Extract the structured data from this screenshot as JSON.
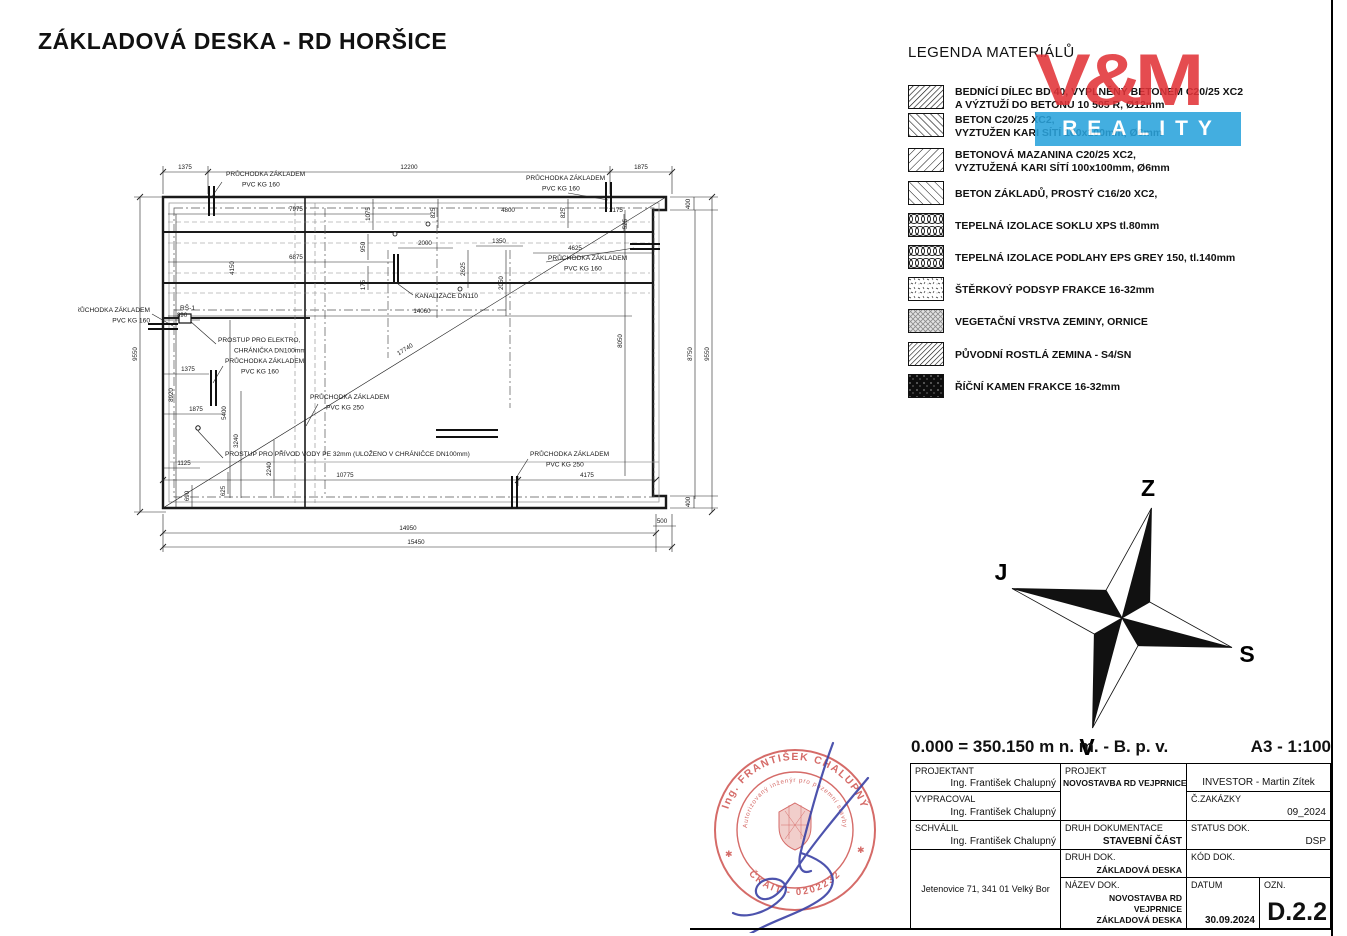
{
  "title": "ZÁKLADOVÁ DESKA - RD HORŠICE",
  "logo": {
    "top": "V&M",
    "bottom": "REALITY",
    "red": "#e23439",
    "blue": "#2aa3dc"
  },
  "legend": {
    "heading": "LEGENDA MATERIÁLŮ",
    "items": [
      {
        "line1": "BEDNÍCÍ DÍLEC BD 40, VYPLNĚNÝ BETONEM C20/25 XC2",
        "line2": "A VÝZTUŽÍ DO BETONU 10 505 R, Ø12mm"
      },
      {
        "line1": "BETON C20/25 XC2,",
        "line2": "VYZTUŽEN KARI SÍTÍ 100x100mm, Ø6mm"
      },
      {
        "line1": "BETONOVÁ MAZANINA C20/25 XC2,",
        "line2": "VYZTUŽENÁ KARI SÍTÍ 100x100mm, Ø6mm"
      },
      {
        "line1": "BETON ZÁKLADŮ, PROSTÝ C16/20 XC2,",
        "line2": ""
      },
      {
        "line1": "TEPELNÁ IZOLACE SOKLU XPS tl.80mm",
        "line2": ""
      },
      {
        "line1": "TEPELNÁ IZOLACE PODLAHY EPS GREY 150, tl.140mm",
        "line2": ""
      },
      {
        "line1": "ŠTĚRKOVÝ PODSYP FRAKCE 16-32mm",
        "line2": ""
      },
      {
        "line1": "VEGETAČNÍ VRSTVA ZEMINY, ORNICE",
        "line2": ""
      },
      {
        "line1": "PŮVODNÍ ROSTLÁ ZEMINA - S4/SN",
        "line2": ""
      },
      {
        "line1": "ŘÍČNÍ KAMEN FRAKCE 16-32mm",
        "line2": ""
      }
    ]
  },
  "plan": {
    "dim_labels": [
      {
        "t": "1375",
        "x": 107,
        "y": 11
      },
      {
        "t": "12200",
        "x": 331,
        "y": 11
      },
      {
        "t": "1875",
        "x": 563,
        "y": 11
      },
      {
        "t": "7975",
        "x": 218,
        "y": 53
      },
      {
        "t": "1075",
        "x": 292,
        "y": 56,
        "r": -90
      },
      {
        "t": "825",
        "x": 357,
        "y": 55,
        "r": -90
      },
      {
        "t": "4800",
        "x": 430,
        "y": 54
      },
      {
        "t": "825",
        "x": 487,
        "y": 55,
        "r": -90
      },
      {
        "t": "2175",
        "x": 538,
        "y": 54
      },
      {
        "t": "525",
        "x": 549,
        "y": 66,
        "r": -90
      },
      {
        "t": "400",
        "x": 612,
        "y": 46,
        "r": -90
      },
      {
        "t": "6875",
        "x": 218,
        "y": 101
      },
      {
        "t": "950",
        "x": 287,
        "y": 89,
        "r": -90
      },
      {
        "t": "2000",
        "x": 347,
        "y": 87
      },
      {
        "t": "2625",
        "x": 387,
        "y": 111,
        "r": -90
      },
      {
        "t": "1350",
        "x": 421,
        "y": 85
      },
      {
        "t": "2050",
        "x": 425,
        "y": 125,
        "r": -90
      },
      {
        "t": "4625",
        "x": 497,
        "y": 92
      },
      {
        "t": "175",
        "x": 287,
        "y": 127,
        "r": -90
      },
      {
        "t": "4150",
        "x": 156,
        "y": 110,
        "r": -90
      },
      {
        "t": "14060",
        "x": 344,
        "y": 155
      },
      {
        "t": "17740",
        "x": 328,
        "y": 193,
        "r": -31.5
      },
      {
        "t": "890",
        "x": 104,
        "y": 159
      },
      {
        "t": "8920",
        "x": 95,
        "y": 237,
        "r": -90
      },
      {
        "t": "9550",
        "x": 59,
        "y": 196,
        "r": -90
      },
      {
        "t": "1375",
        "x": 110,
        "y": 213
      },
      {
        "t": "1875",
        "x": 118,
        "y": 253
      },
      {
        "t": "5400",
        "x": 148,
        "y": 255,
        "r": -90
      },
      {
        "t": "3240",
        "x": 160,
        "y": 283,
        "r": -90
      },
      {
        "t": "1125",
        "x": 106,
        "y": 307
      },
      {
        "t": "2240",
        "x": 193,
        "y": 311,
        "r": -90
      },
      {
        "t": "690",
        "x": 111,
        "y": 338,
        "r": -90
      },
      {
        "t": "625",
        "x": 147,
        "y": 333,
        "r": -90
      },
      {
        "t": "10775",
        "x": 267,
        "y": 319
      },
      {
        "t": "4175",
        "x": 509,
        "y": 319
      },
      {
        "t": "8050",
        "x": 544,
        "y": 183,
        "r": -90
      },
      {
        "t": "8750",
        "x": 614,
        "y": 196,
        "r": -90
      },
      {
        "t": "9550",
        "x": 631,
        "y": 196,
        "r": -90
      },
      {
        "t": "400",
        "x": 612,
        "y": 344,
        "r": -90
      },
      {
        "t": "500",
        "x": 584,
        "y": 365
      },
      {
        "t": "14950",
        "x": 330,
        "y": 372
      },
      {
        "t": "15450",
        "x": 338,
        "y": 386
      }
    ],
    "annotations": [
      {
        "lines": [
          "PRŮCHODKA ZÁKLADEM",
          "PVC KG 160"
        ],
        "x": 148,
        "y": 18,
        "anchor": "start"
      },
      {
        "lines": [
          "PRŮCHODKA ZÁKLADEM",
          "PVC KG 160"
        ],
        "x": 448,
        "y": 22,
        "anchor": "start"
      },
      {
        "lines": [
          "PRŮCHODKA ZÁKLADEM",
          "PVC KG 160"
        ],
        "x": 470,
        "y": 102,
        "anchor": "start"
      },
      {
        "lines": [
          "PRŮCHODKA ZÁKLADEM",
          "PVC KG 160"
        ],
        "x": 72,
        "y": 154,
        "anchor": "end"
      },
      {
        "lines": [
          "RŠ-1"
        ],
        "x": 102,
        "y": 152,
        "anchor": "start"
      },
      {
        "lines": [
          "PROSTUP PRO ELEKTRO,",
          "CHRÁNIČKA DN100mm"
        ],
        "x": 140,
        "y": 184,
        "anchor": "start"
      },
      {
        "lines": [
          "PRŮCHODKA ZÁKLADEM",
          "PVC KG 160"
        ],
        "x": 147,
        "y": 205,
        "anchor": "start"
      },
      {
        "lines": [
          "PRŮCHODKA ZÁKLADEM",
          "PVC KG 250"
        ],
        "x": 232,
        "y": 241,
        "anchor": "start"
      },
      {
        "lines": [
          "PROSTUP PRO PŘÍVOD VODY PE 32mm (ULOŽENO V CHRÁNIČCE DN100mm)"
        ],
        "x": 147,
        "y": 298,
        "anchor": "start"
      },
      {
        "lines": [
          "PRŮCHODKA ZÁKLADEM",
          "PVC KG 250"
        ],
        "x": 452,
        "y": 298,
        "anchor": "start"
      },
      {
        "lines": [
          "KANALIZACE DN110"
        ],
        "x": 337,
        "y": 140,
        "anchor": "start"
      }
    ]
  },
  "compass": {
    "top": "Z",
    "left": "J",
    "right": "S",
    "bottom": "V"
  },
  "titleblock": {
    "elevation": "0.000 = 350.150 m n. m. - B. p. v.",
    "format_scale": "A3 - 1:100",
    "projektant_label": "PROJEKTANT",
    "projektant": "Ing. František Chalupný",
    "vypracoval_label": "VYPRACOVAL",
    "vypracoval": "Ing. František Chalupný",
    "schvalil_label": "SCHVÁLIL",
    "schvalil": "Ing. František Chalupný",
    "address": "Jetenovice 71, 341 01 Velký Bor",
    "projekt_label": "PROJEKT",
    "projekt": "NOVOSTAVBA RD VEJPRNICE",
    "druh_dokumentace_label": "DRUH DOKUMENTACE",
    "druh_dokumentace": "STAVEBNÍ ČÁST",
    "druh_dok_label": "DRUH DOK.",
    "druh_dok": "ZÁKLADOVÁ DESKA",
    "nazev_dok_label": "NÁZEV DOK.",
    "nazev_dok_line1": "NOVOSTAVBA RD VEJPRNICE",
    "nazev_dok_line2": "ZÁKLADOVÁ DESKA",
    "investor": "INVESTOR - Martin Zítek",
    "zakazka_label": "Č.ZAKÁZKY",
    "zakazka": "09_2024",
    "status_label": "STATUS DOK.",
    "status": "DSP",
    "kod_label": "KÓD DOK.",
    "kod": "",
    "datum_label": "DATUM",
    "datum": "30.09.2024",
    "ozn_label": "OZN.",
    "ozn": "D.2.2"
  },
  "stamp": {
    "arc_top": "Ing. FRANTIŠEK CHALUPNÝ",
    "arc_mid": "Autorizovaný inženýr pro pozemní stavby",
    "arc_bottom": "ČKAIT - 0202232",
    "red": "#cb4743",
    "signature_blue": "#3a41a5"
  }
}
